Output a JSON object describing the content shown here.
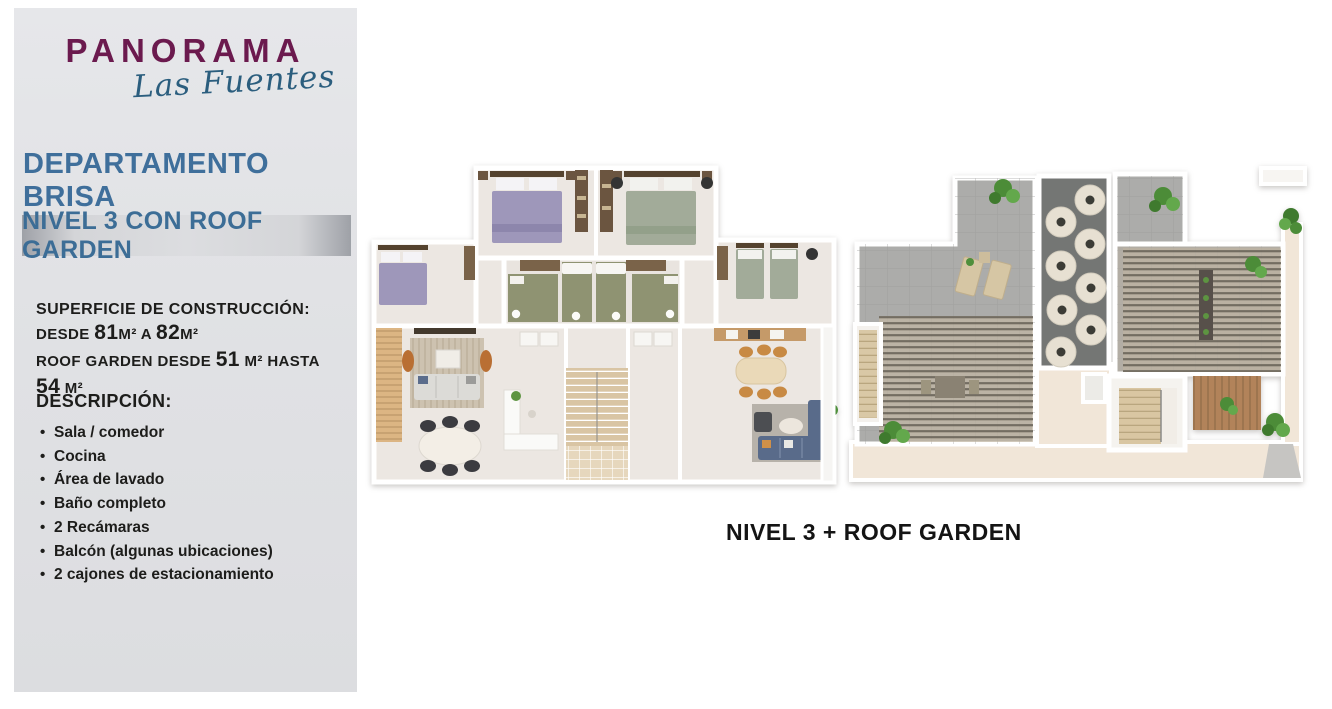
{
  "sidebar": {
    "logo": {
      "brand": "PANORAMA",
      "sub": "Las Fuentes"
    },
    "title": "DEPARTAMENTO BRISA",
    "level_badge": "NIVEL 3 CON ROOF GARDEN",
    "superficie": {
      "heading": "SUPERFICIE DE CONSTRUCCIÓN:",
      "line2": [
        "DESDE ",
        "81",
        "M²",
        " A ",
        "82",
        "M²"
      ],
      "line3": [
        "ROOF GARDEN DESDE ",
        "51",
        " M²",
        " HASTA ",
        "54",
        " M²"
      ]
    },
    "descripcion": {
      "heading": "DESCRIPCIÓN:",
      "items": [
        "Sala / comedor",
        "Cocina",
        "Área de lavado",
        "Baño completo",
        "2 Recámaras",
        "Balcón (algunas ubicaciones)",
        "2 cajones de estacionamiento"
      ]
    }
  },
  "main": {
    "caption": "NIVEL 3 + ROOF GARDEN"
  },
  "colors": {
    "brand_plum": "#6b1a4e",
    "script_teal": "#2b5e7e",
    "heading_blue": "#3f6f9b",
    "panel_gray": "#e1e2e5",
    "badge_gray": "#a7aaaf",
    "text_dark": "#1d1d1b"
  }
}
